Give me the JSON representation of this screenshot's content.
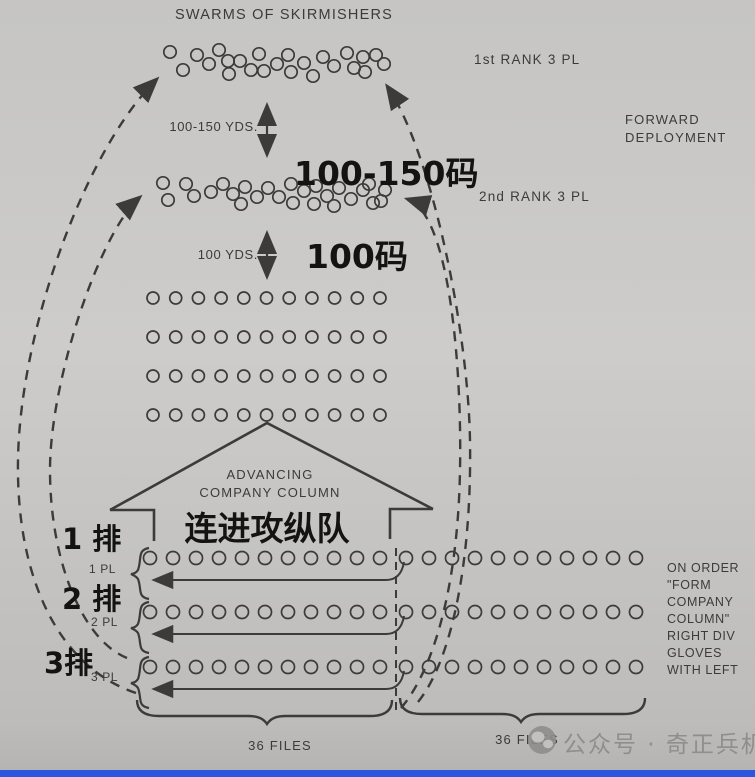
{
  "title": "SWARMS OF SKIRMISHERS",
  "labels": {
    "rank1": "1st RANK 3 PL",
    "rank2": "2nd RANK 3 PL",
    "forward_deployment_line1": "FORWARD",
    "forward_deployment_line2": "DEPLOYMENT",
    "dist1": "100-150 YDS.",
    "dist1_cn": "100-150码",
    "dist2": "100 YDS.",
    "dist2_cn": "100码",
    "advancing_line1": "ADVANCING",
    "advancing_line2": "COMPANY COLUMN",
    "advancing_cn": "连进攻纵队",
    "pl1_cn": "1 排",
    "pl1": "1 PL",
    "pl2_cn": "2 排",
    "pl2": "2 PL",
    "pl3_cn": "3排",
    "pl3": "3 PL",
    "files_left": "36 FILES",
    "files_right": "36 FILES",
    "order_note_lines": [
      "ON ORDER",
      "\"FORM",
      "COMPANY",
      "COLUMN\"",
      "RIGHT DIV",
      "GLOVES",
      "WITH LEFT"
    ],
    "watermark": "公众号 · 奇正兵机"
  },
  "colors": {
    "paper_top": "#c6c5c3",
    "paper_mid": "#cdccca",
    "paper_bottom": "#b4b3b1",
    "ink": "#3c3b39",
    "overlay_ink": "#131312",
    "watermark_gray": "#8f8e8c",
    "bottom_bar_blue": "#2e55e0"
  },
  "diagram": {
    "skirmish_row1": {
      "r": 6.2,
      "points": [
        [
          170,
          52
        ],
        [
          183,
          70
        ],
        [
          197,
          55
        ],
        [
          209,
          64
        ],
        [
          219,
          50
        ],
        [
          228,
          61
        ],
        [
          240,
          61
        ],
        [
          229,
          74
        ],
        [
          251,
          70
        ],
        [
          259,
          54
        ],
        [
          264,
          71
        ],
        [
          277,
          64
        ],
        [
          288,
          55
        ],
        [
          291,
          72
        ],
        [
          304,
          63
        ],
        [
          313,
          76
        ],
        [
          323,
          57
        ],
        [
          334,
          66
        ],
        [
          347,
          53
        ],
        [
          354,
          68
        ],
        [
          365,
          72
        ],
        [
          363,
          57
        ],
        [
          376,
          55
        ],
        [
          384,
          64
        ]
      ]
    },
    "skirmish_row2": {
      "r": 6.2,
      "points": [
        [
          163,
          183
        ],
        [
          186,
          184
        ],
        [
          168,
          200
        ],
        [
          194,
          196
        ],
        [
          211,
          192
        ],
        [
          223,
          184
        ],
        [
          233,
          194
        ],
        [
          245,
          187
        ],
        [
          241,
          204
        ],
        [
          257,
          197
        ],
        [
          268,
          188
        ],
        [
          279,
          197
        ],
        [
          291,
          184
        ],
        [
          293,
          203
        ],
        [
          304,
          191
        ],
        [
          316,
          186
        ],
        [
          314,
          204
        ],
        [
          327,
          196
        ],
        [
          339,
          188
        ],
        [
          334,
          206
        ],
        [
          351,
          199
        ],
        [
          363,
          190
        ],
        [
          369,
          184
        ],
        [
          381,
          201
        ],
        [
          385,
          190
        ],
        [
          373,
          203
        ]
      ]
    },
    "column_rows": {
      "x0": 153,
      "dx": 22.7,
      "count": 11,
      "ys": [
        298,
        337,
        376,
        415
      ],
      "r": 6
    },
    "bottom_rows": {
      "ys": [
        558,
        612,
        667
      ],
      "r": 6.5,
      "left": {
        "x0": 150,
        "dx": 23,
        "count": 11
      },
      "right": {
        "x0": 406,
        "dx": 23,
        "count": 11
      }
    }
  }
}
